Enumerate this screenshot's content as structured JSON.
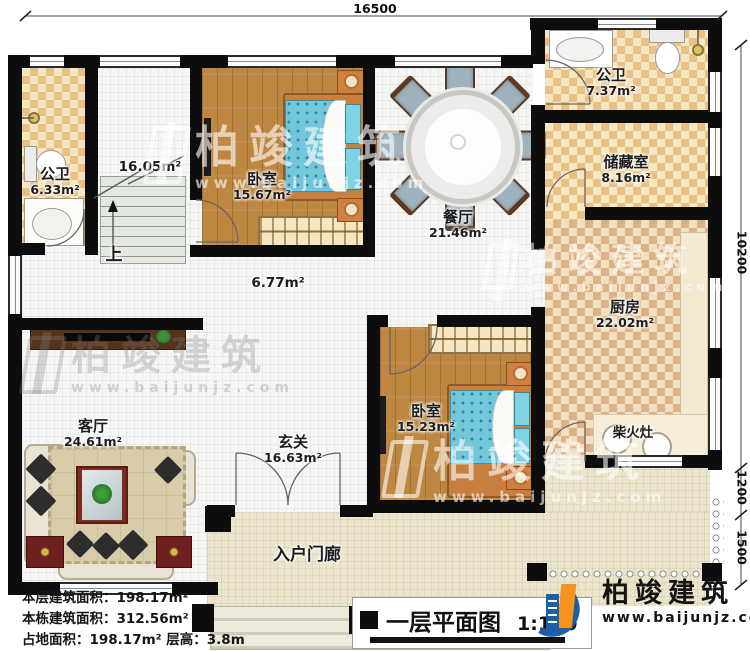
{
  "plan": {
    "dims": {
      "top": "16500",
      "right_main": "10200",
      "right_mid": "1200",
      "right_bottom": "1500"
    },
    "rooms": {
      "bath1": {
        "name": "公卫",
        "area": "6.33m²"
      },
      "stairwell": {
        "area": "16.05m²",
        "up_label": "上"
      },
      "bedroom1": {
        "name": "卧室",
        "area": "15.67m²"
      },
      "dining": {
        "name": "餐厅",
        "area": "21.46m²"
      },
      "bath2": {
        "name": "公卫",
        "area": "7.37m²"
      },
      "storage": {
        "name": "储藏室",
        "area": "8.16m²"
      },
      "kitchen": {
        "name": "厨房",
        "area": "22.02m²"
      },
      "stove": {
        "name": "柴火灶"
      },
      "bedroom2": {
        "name": "卧室",
        "area": "15.23m²"
      },
      "hallway": {
        "area": "6.77m²"
      },
      "living": {
        "name": "客厅",
        "area": "24.61m²"
      },
      "entry": {
        "name": "玄关",
        "area": "16.63m²"
      },
      "porch": {
        "name": "入户门廊"
      }
    },
    "footer": {
      "line1": "本层建筑面积：198.17m²",
      "line2": "本栋建筑面积：312.56m²",
      "line3": "占地面积：198.17m²  层高：3.8m"
    },
    "titleblock": {
      "title": "一层平面图",
      "scale": "1:100"
    },
    "brand": {
      "name": "柏竣建筑",
      "url": "www.baijunjz.com"
    },
    "watermark": {
      "name": "柏竣建筑",
      "url": "www.baijunjz.com"
    },
    "colors": {
      "wall": "#0d0d0d",
      "wood": "#bd8742",
      "tile_light": "#f6e7c4",
      "tile_dark": "#eac083",
      "bed_blue": "#72c6da",
      "brand_blue": "#1b5fa6",
      "brand_orange": "#f6921e"
    }
  }
}
